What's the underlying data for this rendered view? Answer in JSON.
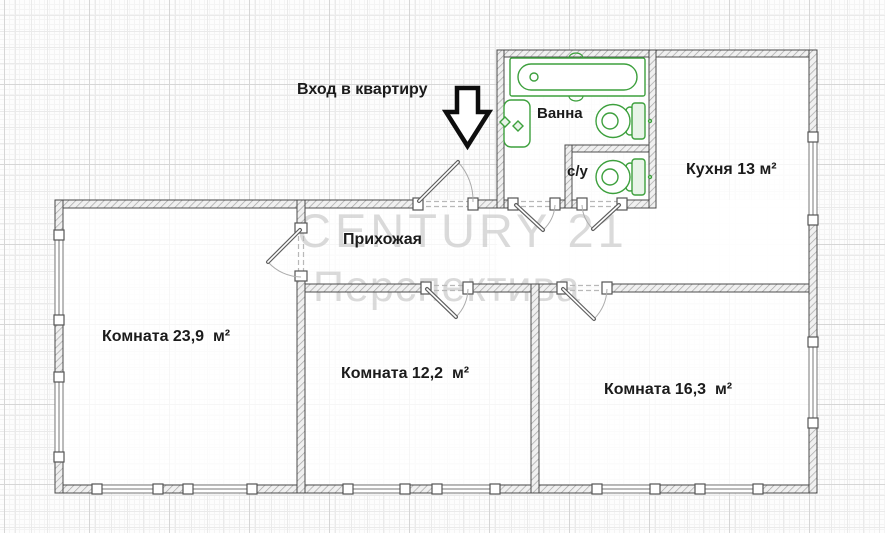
{
  "plan": {
    "entrance_label": "Вход в квартиру",
    "hallway_label": "Прихожая",
    "bathroom_label": "Ванна",
    "wc_label": "с/у",
    "kitchen_label": "Кухня 13 м²",
    "room1_label": "Комната 23,9  м²",
    "room2_label": "Комната 12,2  м²",
    "room3_label": "Комната 16,3  м²"
  },
  "watermark": {
    "line1": "CENTURY 21",
    "line2": "Перспектива"
  },
  "colors": {
    "fixture_green": "#3da03d",
    "wall_outline": "#4b4b4b",
    "label_text": "#1b1b1b",
    "watermark": "#bdbdbd"
  }
}
